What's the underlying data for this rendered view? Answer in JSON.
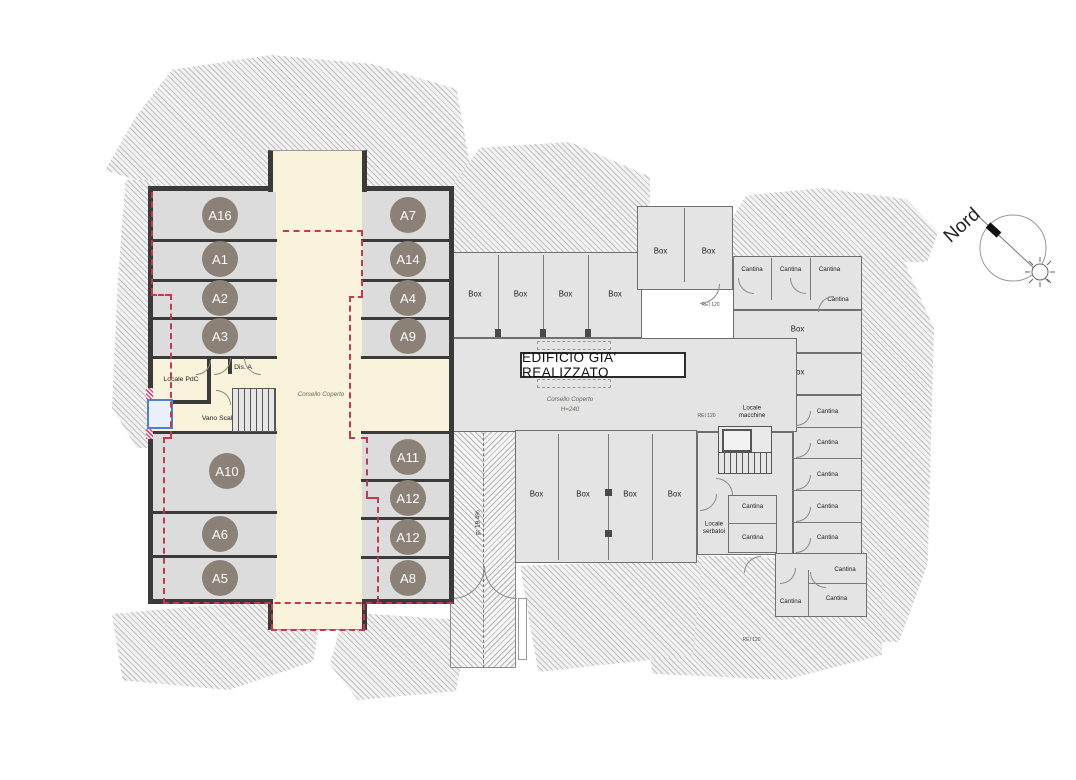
{
  "compass": {
    "label": "Nord"
  },
  "building_a": {
    "stalls": {
      "top_left": [
        "A16",
        "A1",
        "A2",
        "A3"
      ],
      "top_right": [
        "A7",
        "A14",
        "A4",
        "A9"
      ],
      "bottom_left": [
        "A10",
        "A6",
        "A5"
      ],
      "bottom_right": [
        "A11",
        "A12",
        "A12",
        "A8"
      ]
    },
    "rooms": {
      "locale_pdc": "Locale PdC",
      "dis_a": "Dis. A",
      "vano_scala": "Vano Scala A"
    },
    "corridor_label": "Corsello Coperto"
  },
  "building_b": {
    "banner": "EDIFICIO GIA' REALIZZATO",
    "corridor_label": "Corsello Coperto",
    "corridor_height": "H=240",
    "labels": {
      "box": "Box",
      "box_variant": "Dox",
      "cantina": "Cantina",
      "locale_macchine": "Locale macchine",
      "locale_serbatoi": "Locale serbatoi",
      "rei": "REI 120"
    }
  },
  "ramp": {
    "slope_label": "p: 19.4%"
  },
  "colors": {
    "corridor_fill": "#f8f3da",
    "stall_fill": "#dcdcdc",
    "wall_dark": "#3a3a3a",
    "badge_fill": "#8b8177",
    "boundary_dash": "#c3394e",
    "existing_fill": "#e4e4e4",
    "existing_wall": "#6f6f6f",
    "elevator_accent": "#4f7fd0"
  }
}
